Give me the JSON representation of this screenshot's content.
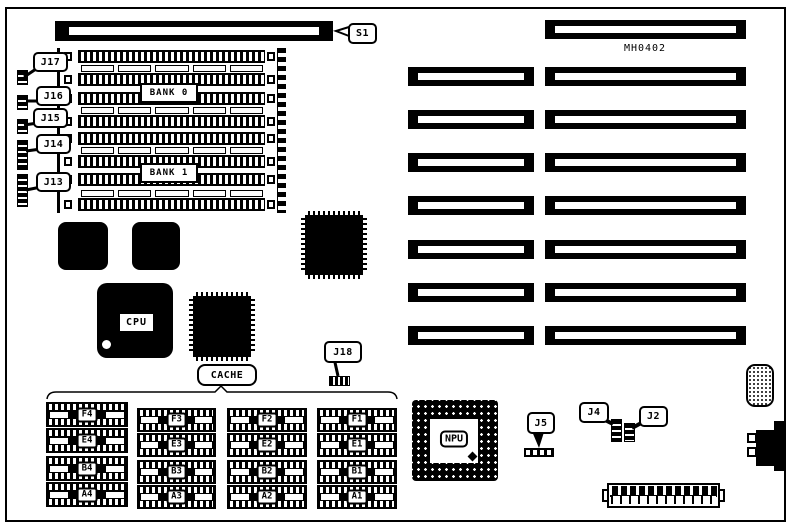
{
  "part_number": "MH0402",
  "labels": {
    "s1": "S1",
    "j17": "J17",
    "j16": "J16",
    "j15": "J15",
    "j14": "J14",
    "j13": "J13",
    "j18": "J18",
    "j5": "J5",
    "j4": "J4",
    "j2": "J2",
    "bank0": "BANK 0",
    "bank1": "BANK 1",
    "cpu": "CPU",
    "npu": "NPU",
    "cache": "CACHE"
  },
  "cache_grid": {
    "columns": [
      [
        "F4",
        "E4",
        "B4",
        "A4"
      ],
      [
        "F3",
        "E3",
        "B3",
        "A3"
      ],
      [
        "F2",
        "E2",
        "B2",
        "A2"
      ],
      [
        "F1",
        "E1",
        "B1",
        "A1"
      ]
    ]
  },
  "colors": {
    "ink": "#000000",
    "paper": "#ffffff"
  }
}
